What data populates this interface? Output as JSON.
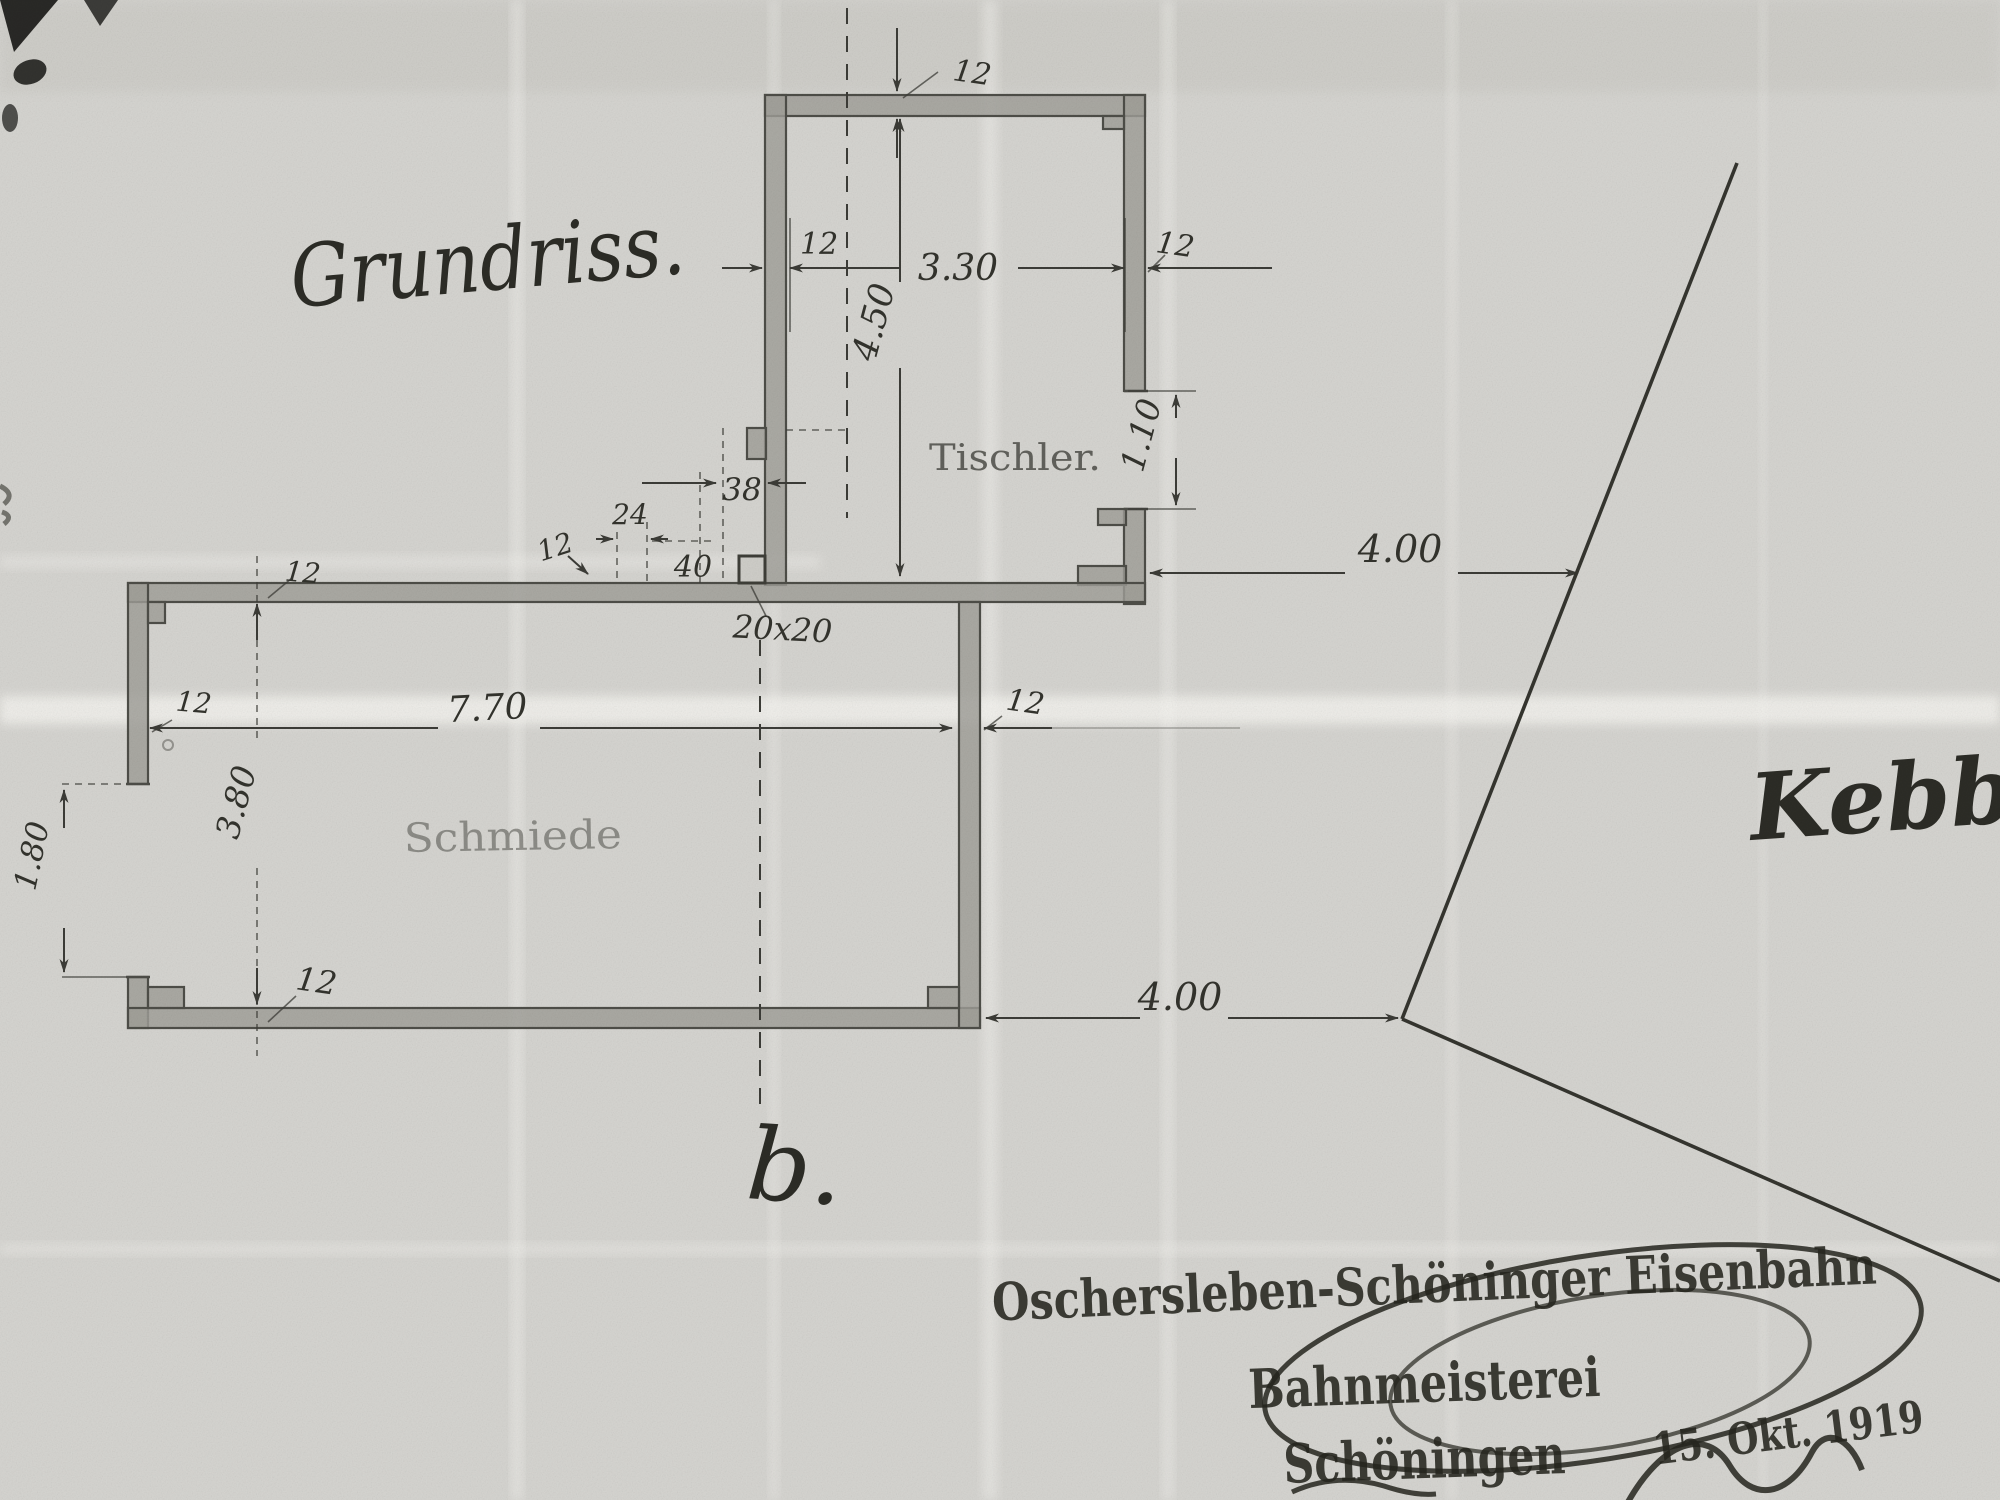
{
  "document": {
    "title": "Grundriss.",
    "section_label": "b.",
    "annotation_name": "Kebbel"
  },
  "plan": {
    "rooms": {
      "upper": "Tischler.",
      "lower": "Schmiede"
    },
    "dims": {
      "wall": "12",
      "tischler_width": "3.30",
      "tischler_depth": "4.50",
      "tischler_opening": "1.10",
      "offset_upper": "4.00",
      "offset_lower": "4.00",
      "jamb": "38",
      "pier": "24",
      "flue": "40",
      "post": "20x20",
      "schmiede_width": "7.70",
      "schmiede_depth": "3.80",
      "schmiede_opening": "1.80"
    }
  },
  "stamp": {
    "line1": "Oschersleben-Schöninger Eisenbahn",
    "line2": "Bahnmeisterei",
    "line3": "Schöningen",
    "date": "15. Okt. 1919"
  },
  "colors": {
    "paper": "#d6d5d1",
    "ink": "#3c3c37",
    "wall_fill": "#a09f98",
    "stamp_ink": "#26261f"
  }
}
